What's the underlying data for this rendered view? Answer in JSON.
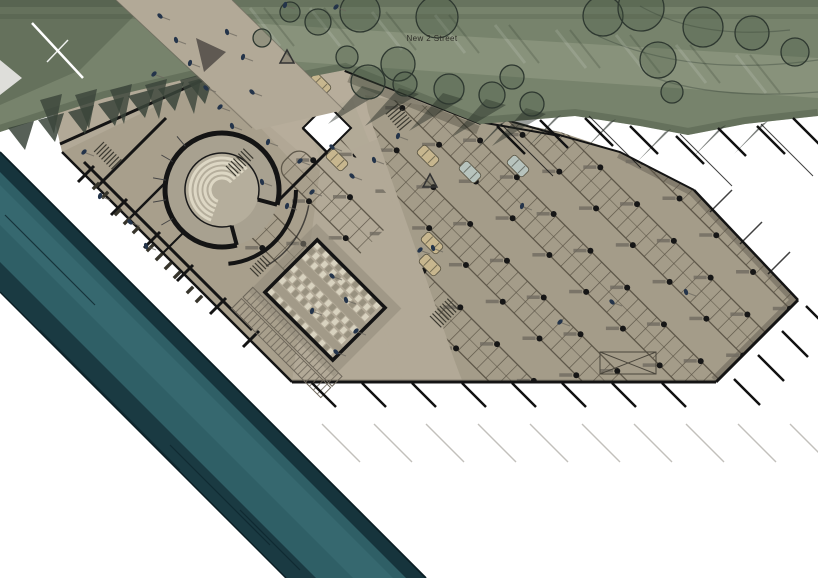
{
  "labels": {
    "street_name": "New 2 Street"
  },
  "colors": {
    "background": "#ffffff",
    "green_base": "#77836c",
    "green_light": "#99a28a",
    "green_dark": "#4f5c49",
    "green_shadow": "#39443a",
    "plaza": "#b2a997",
    "plaza_dark": "#9e9582",
    "parking": "#a49c89",
    "edge_dark_band": "#7b7466",
    "wall": "#141414",
    "stall_line": "#575043",
    "column_dot": "#161616",
    "column_shadow": "#6f6a60",
    "river_dark": "#16343c",
    "river_main": "#2f5f66",
    "river_light": "#41737a",
    "river_edge_line": "#0b1e24",
    "hall_light": "#d8d2bf",
    "hall_dark": "#98917f",
    "seat_arc": "#ddd7c4",
    "car_tan": "#c7b68e",
    "car_silver": "#b7c3bd",
    "person": "#24344a",
    "tick": "#111111",
    "ghost_tick": "#b8b6b0",
    "text": "#2e2e28"
  },
  "street": {
    "label_x": 432,
    "label_y": 41
  },
  "trees": [
    [
      318,
      22,
      13,
      0
    ],
    [
      360,
      12,
      20,
      0
    ],
    [
      437,
      17,
      21,
      0
    ],
    [
      398,
      64,
      17,
      0
    ],
    [
      347,
      57,
      11,
      0
    ],
    [
      512,
      77,
      12,
      0
    ],
    [
      603,
      16,
      20,
      0
    ],
    [
      641,
      8,
      23,
      0
    ],
    [
      658,
      60,
      18,
      0
    ],
    [
      703,
      27,
      20,
      0
    ],
    [
      752,
      33,
      17,
      0
    ],
    [
      795,
      52,
      14,
      0
    ],
    [
      672,
      92,
      11,
      0
    ],
    [
      290,
      12,
      10,
      0
    ],
    [
      262,
      38,
      9,
      0
    ],
    [
      368,
      82,
      17,
      1
    ],
    [
      405,
      84,
      12,
      1
    ],
    [
      449,
      89,
      15,
      1
    ],
    [
      492,
      95,
      13,
      1
    ],
    [
      532,
      104,
      12,
      1
    ]
  ],
  "green": {
    "sawtooth_big": [
      [
        40,
        100
      ],
      [
        75,
        95
      ],
      [
        110,
        90
      ],
      [
        145,
        85
      ],
      [
        180,
        80
      ]
    ],
    "sawtooth_small": [
      [
        8,
        128
      ],
      [
        38,
        120
      ],
      [
        68,
        112
      ],
      [
        98,
        104
      ],
      [
        128,
        96
      ],
      [
        158,
        89
      ],
      [
        188,
        82
      ]
    ],
    "spikes": [
      [
        500,
        124
      ],
      [
        555,
        118
      ],
      [
        610,
        122
      ],
      [
        665,
        132
      ],
      [
        720,
        128
      ],
      [
        762,
        124
      ]
    ],
    "edge_ticks": [
      [
        497,
        126
      ],
      [
        540,
        120
      ],
      [
        585,
        118
      ],
      [
        630,
        126
      ],
      [
        676,
        136
      ],
      [
        718,
        128
      ],
      [
        757,
        126
      ],
      [
        793,
        118
      ]
    ],
    "streaks": [
      [
        250,
        8
      ],
      [
        310,
        8
      ],
      [
        372,
        12
      ],
      [
        435,
        15
      ],
      [
        495,
        25
      ],
      [
        556,
        30
      ],
      [
        616,
        35
      ],
      [
        676,
        45
      ],
      [
        736,
        55
      ]
    ]
  },
  "people": [
    [
      160,
      16
    ],
    [
      176,
      40
    ],
    [
      190,
      63
    ],
    [
      154,
      74
    ],
    [
      206,
      88
    ],
    [
      227,
      32
    ],
    [
      243,
      57
    ],
    [
      220,
      107
    ],
    [
      252,
      92
    ],
    [
      232,
      126
    ],
    [
      268,
      142
    ],
    [
      300,
      161
    ],
    [
      332,
      147
    ],
    [
      262,
      182
    ],
    [
      287,
      206
    ],
    [
      312,
      192
    ],
    [
      352,
      176
    ],
    [
      374,
      160
    ],
    [
      285,
      5
    ],
    [
      336,
      7
    ],
    [
      332,
      276
    ],
    [
      346,
      300
    ],
    [
      312,
      311
    ],
    [
      356,
      331
    ],
    [
      336,
      352
    ],
    [
      433,
      248
    ],
    [
      522,
      206
    ],
    [
      560,
      322
    ],
    [
      612,
      302
    ],
    [
      686,
      292
    ],
    [
      100,
      196
    ],
    [
      84,
      152
    ],
    [
      130,
      222
    ],
    [
      146,
      246
    ],
    [
      398,
      136
    ],
    [
      420,
      250
    ]
  ],
  "cars": [
    [
      337,
      160,
      "tan"
    ],
    [
      428,
      156,
      "tan"
    ],
    [
      470,
      172,
      "silver"
    ],
    [
      432,
      243,
      "tan"
    ],
    [
      430,
      265,
      "tan"
    ],
    [
      320,
      84,
      "tan"
    ],
    [
      518,
      166,
      "silver"
    ]
  ],
  "parking_grid": {
    "cx": 560,
    "cy": 260,
    "angle": 45,
    "rows": [
      -144,
      -78,
      -12,
      54,
      120,
      186
    ],
    "u0": -265,
    "u1": 235,
    "island_h": 32,
    "stall_step": 13,
    "dot_step": 52,
    "dot_r": 3
  },
  "amphitheater": {
    "cx": 222,
    "cy": 190,
    "r_outer": 57,
    "r_inner": 37,
    "seat_radii": [
      12,
      17,
      22,
      27,
      32
    ],
    "gap_start_deg": 15,
    "gap_end_deg": 75,
    "corridor_r": 74
  },
  "hall": {
    "cx": 325,
    "cy": 300,
    "angle": 45,
    "w": 96,
    "h": 74,
    "rows": 9,
    "cell": 6
  },
  "stairs": [
    [
      398,
      104,
      50,
      7,
      16
    ],
    [
      104,
      142,
      45,
      8,
      14
    ],
    [
      226,
      166,
      -45,
      8,
      14
    ],
    [
      430,
      316,
      -45,
      8,
      16
    ],
    [
      250,
      268,
      -45,
      6,
      12
    ]
  ],
  "benches": [
    [
      118,
      212
    ],
    [
      127,
      221
    ],
    [
      136,
      230
    ],
    [
      150,
      248
    ],
    [
      159,
      257
    ],
    [
      96,
      186
    ],
    [
      105,
      195
    ],
    [
      168,
      266
    ],
    [
      177,
      275
    ],
    [
      190,
      290
    ],
    [
      199,
      299
    ]
  ],
  "wall_stubs": [
    [
      85,
      175
    ],
    [
      118,
      208
    ],
    [
      151,
      241
    ],
    [
      184,
      274
    ],
    [
      217,
      307
    ],
    [
      250,
      340
    ]
  ],
  "ticks": {
    "bottom": {
      "x0": 312,
      "step": 50,
      "count": 8,
      "len": 24,
      "y": 383
    },
    "bevel": [
      [
        806,
        306
      ],
      [
        782,
        331
      ],
      [
        758,
        355
      ],
      [
        734,
        379
      ]
    ],
    "right_edge": [
      [
        716,
        206
      ],
      [
        746,
        238
      ],
      [
        774,
        268
      ]
    ],
    "ghost": {
      "x0": 322,
      "y": 424,
      "step": 52,
      "count": 10,
      "len": 38
    }
  },
  "river": {
    "streaks": [
      [
        5,
        215,
        90
      ],
      [
        40,
        330,
        140
      ],
      [
        170,
        445,
        100
      ],
      [
        240,
        510,
        60
      ]
    ]
  }
}
